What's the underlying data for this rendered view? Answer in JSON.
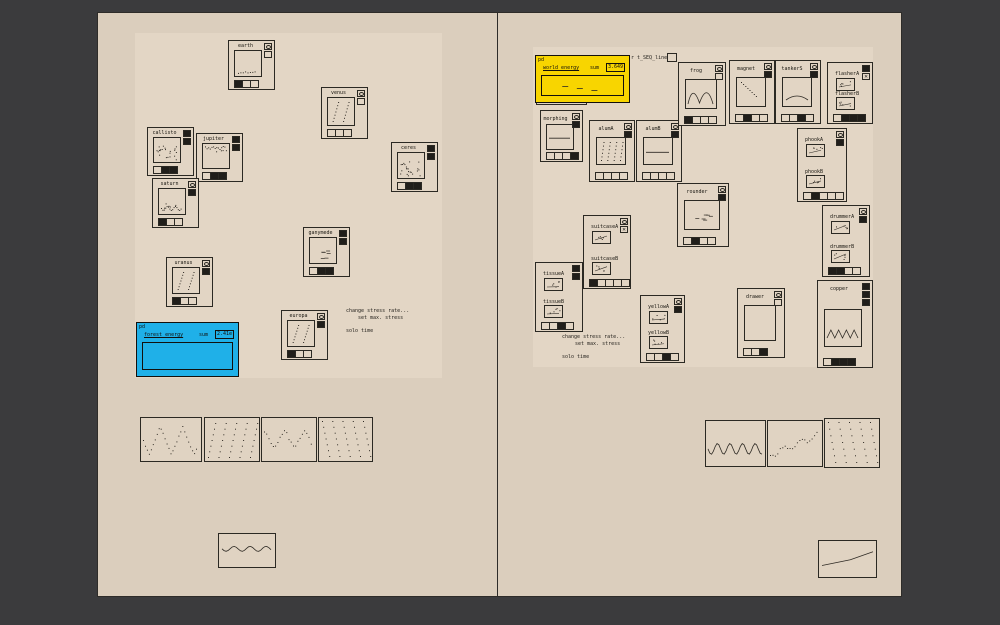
{
  "window": {
    "bg": "#3b3b3d",
    "page_bg": "#dbcebd",
    "panel_bg": "#e3d6c5",
    "accent_yellow": "#f8d500",
    "accent_blue": "#1fb0e8",
    "ink": "#2b2923"
  },
  "comments": {
    "left": {
      "line1": "change stress rate...",
      "line2": "set max. stress",
      "line3": "solo time"
    },
    "right": {
      "line1": "change stress rate...",
      "line2": "set max. stress",
      "line3": "solo time"
    }
  },
  "objects": {
    "saved_energy": {
      "label": "pd saved energy"
    },
    "receive_line": {
      "label": "r t_SEQ_line"
    }
  },
  "energy_boxes": [
    {
      "id": "forest",
      "pd_label": "pd",
      "name": "forest_energy",
      "sum_label": "sum",
      "value": "2.41e",
      "color": "#1fb0e8",
      "x": 136,
      "y": 322,
      "w": 103,
      "h": 55,
      "trace": "empty"
    },
    {
      "id": "world",
      "pd_label": "pd",
      "name": "world_energy",
      "sum_label": "sum",
      "value": "3.649",
      "color": "#f8d500",
      "x": 535,
      "y": 55,
      "w": 95,
      "h": 48,
      "trace": "edash"
    }
  ],
  "modules": [
    {
      "id": "earth",
      "label": "earth",
      "type": "planet",
      "x": 228,
      "y": 40,
      "w": 47,
      "h": 50,
      "trace": "dots-bottom",
      "top": [
        "bang",
        "toggle"
      ],
      "cells": [
        "d",
        "l",
        "l"
      ]
    },
    {
      "id": "venus",
      "label": "venus",
      "type": "planet",
      "x": 321,
      "y": 87,
      "w": 47,
      "h": 52,
      "trace": "diag2",
      "top": [
        "bang",
        "toggle"
      ],
      "cells": [
        "l",
        "l",
        "l"
      ]
    },
    {
      "id": "callisto",
      "label": "callisto",
      "type": "planet",
      "x": 147,
      "y": 127,
      "w": 47,
      "h": 49,
      "trace": "scatter",
      "top": [
        "dark",
        "dark"
      ],
      "cells": [
        "l",
        "d",
        "d"
      ]
    },
    {
      "id": "jupiter",
      "label": "jupiter",
      "type": "planet",
      "x": 196,
      "y": 133,
      "w": 47,
      "h": 49,
      "trace": "dots-top",
      "top": [
        "dark",
        "dark"
      ],
      "cells": [
        "l",
        "d",
        "d"
      ]
    },
    {
      "id": "saturn",
      "label": "saturn",
      "type": "planet",
      "x": 152,
      "y": 178,
      "w": 47,
      "h": 50,
      "trace": "wave-bottom",
      "top": [
        "bang",
        "dark"
      ],
      "cells": [
        "d",
        "l",
        "l"
      ]
    },
    {
      "id": "ceres",
      "label": "ceres",
      "type": "planet",
      "x": 391,
      "y": 142,
      "w": 47,
      "h": 50,
      "trace": "scatter",
      "top": [
        "dark",
        "dark"
      ],
      "cells": [
        "l",
        "d",
        "d"
      ]
    },
    {
      "id": "ganymede",
      "label": "ganymede",
      "type": "planet",
      "x": 303,
      "y": 227,
      "w": 47,
      "h": 50,
      "trace": "dashes",
      "top": [
        "dark",
        "dark"
      ],
      "cells": [
        "l",
        "d",
        "d"
      ]
    },
    {
      "id": "uranus",
      "label": "uranus",
      "type": "planet",
      "x": 166,
      "y": 257,
      "w": 47,
      "h": 50,
      "trace": "diag2",
      "top": [
        "bang",
        "dark"
      ],
      "cells": [
        "d",
        "l",
        "l"
      ]
    },
    {
      "id": "europa",
      "label": "europa",
      "type": "planet",
      "x": 281,
      "y": 310,
      "w": 47,
      "h": 50,
      "trace": "diag2",
      "top": [
        "bang",
        "dark"
      ],
      "cells": [
        "d",
        "l",
        "l"
      ]
    },
    {
      "id": "morphing",
      "label": "morphing",
      "type": "tall",
      "x": 540,
      "y": 110,
      "w": 43,
      "h": 52,
      "trace": "flat",
      "top": [
        "bang",
        "dark"
      ],
      "cells": [
        "l",
        "l",
        "l",
        "d"
      ],
      "g": [
        5,
        13,
        28,
        26
      ]
    },
    {
      "id": "alumA",
      "label": "alumA",
      "type": "tall",
      "x": 589,
      "y": 120,
      "w": 46,
      "h": 62,
      "trace": "vstripes",
      "top": [
        "bang",
        "dark"
      ],
      "cells": [
        "l",
        "l",
        "l",
        "l"
      ]
    },
    {
      "id": "alumB",
      "label": "alumB",
      "type": "tall",
      "x": 636,
      "y": 120,
      "w": 46,
      "h": 62,
      "trace": "flat",
      "top": [
        "bang",
        "dark"
      ],
      "cells": [
        "l",
        "l",
        "l",
        "l"
      ]
    },
    {
      "id": "frog",
      "label": "frog",
      "type": "tall",
      "x": 678,
      "y": 62,
      "w": 48,
      "h": 64,
      "trace": "bumps",
      "top": [
        "bang",
        "toggle"
      ],
      "cells": [
        "d",
        "l",
        "l",
        "l"
      ]
    },
    {
      "id": "magnet",
      "label": "magnet",
      "type": "tall",
      "x": 729,
      "y": 60,
      "w": 46,
      "h": 64,
      "trace": "falldots",
      "top": [
        "bang",
        "dark"
      ],
      "cells": [
        "l",
        "d",
        "l",
        "l"
      ]
    },
    {
      "id": "tankerS",
      "label": "tankerS",
      "type": "tall",
      "x": 775,
      "y": 60,
      "w": 46,
      "h": 64,
      "trace": "arc",
      "top": [
        "bang",
        "dark"
      ],
      "cells": [
        "l",
        "l",
        "d",
        "l"
      ]
    },
    {
      "id": "flasher",
      "sub_a": "flasherA",
      "sub_b": "flasherB",
      "type": "dual",
      "x": 827,
      "y": 62,
      "w": 46,
      "h": 62,
      "top": [
        "dark",
        "xtog"
      ],
      "cells": [
        "l",
        "d",
        "d",
        "d"
      ]
    },
    {
      "id": "phook",
      "sub_a": "phookA",
      "sub_b": "phookB",
      "type": "dual",
      "x": 797,
      "y": 128,
      "w": 50,
      "h": 74,
      "top": [
        "bang",
        "dark"
      ],
      "cells": [
        "l",
        "d",
        "l",
        "l",
        "l"
      ]
    },
    {
      "id": "rounder",
      "label": "rounder",
      "type": "tall",
      "x": 677,
      "y": 183,
      "w": 52,
      "h": 64,
      "trace": "dashes",
      "top": [
        "bang",
        "dark"
      ],
      "cells": [
        "l",
        "d",
        "l",
        "l"
      ]
    },
    {
      "id": "suitcase",
      "sub_a": "suitcaseA",
      "sub_b": "suitcaseB",
      "type": "dual",
      "x": 583,
      "y": 215,
      "w": 48,
      "h": 74,
      "top": [
        "bang",
        "xtog"
      ],
      "cells": [
        "d",
        "l",
        "l",
        "l",
        "l"
      ]
    },
    {
      "id": "drummer",
      "sub_a": "drummerA",
      "sub_b": "drummerB",
      "type": "dual",
      "x": 822,
      "y": 205,
      "w": 48,
      "h": 72,
      "top": [
        "bang",
        "dark"
      ],
      "cells": [
        "d",
        "d",
        "l",
        "l"
      ]
    },
    {
      "id": "tissue",
      "sub_a": "tissueA",
      "sub_b": "tissueB",
      "type": "dual",
      "x": 535,
      "y": 262,
      "w": 48,
      "h": 70,
      "top": [
        "dark",
        "dark"
      ],
      "cells": [
        "l",
        "l",
        "d",
        "l"
      ]
    },
    {
      "id": "yellow",
      "sub_a": "yellowA",
      "sub_b": "yellowB",
      "type": "dual",
      "x": 640,
      "y": 295,
      "w": 45,
      "h": 68,
      "top": [
        "bang",
        "dark"
      ],
      "cells": [
        "l",
        "l",
        "d",
        "l"
      ]
    },
    {
      "id": "drawer",
      "label": "drawer",
      "type": "tall",
      "x": 737,
      "y": 288,
      "w": 48,
      "h": 70,
      "trace": "empty",
      "top": [
        "bang",
        "toggle"
      ],
      "cells": [
        "l",
        "l",
        "d"
      ]
    },
    {
      "id": "copper",
      "label": "copper",
      "type": "tall",
      "x": 817,
      "y": 280,
      "w": 56,
      "h": 88,
      "trace": "zigzag",
      "top": [
        "dark",
        "dark",
        "dark"
      ],
      "cells": [
        "l",
        "d",
        "d",
        "d"
      ],
      "g": [
        6,
        28,
        38,
        38
      ]
    }
  ],
  "arrays": [
    {
      "id": "arr-l1",
      "x": 140,
      "y": 417,
      "w": 62,
      "h": 45,
      "trace": "zigzagdots"
    },
    {
      "id": "arr-l2",
      "x": 204,
      "y": 417,
      "w": 56,
      "h": 45,
      "trace": "stripes-up"
    },
    {
      "id": "arr-l3",
      "x": 261,
      "y": 417,
      "w": 56,
      "h": 45,
      "trace": "wavescatter"
    },
    {
      "id": "arr-l4",
      "x": 318,
      "y": 417,
      "w": 55,
      "h": 45,
      "trace": "stripes-down"
    },
    {
      "id": "arr-l5",
      "x": 218,
      "y": 533,
      "w": 58,
      "h": 35,
      "trace": "wavyline"
    },
    {
      "id": "arr-r1",
      "x": 705,
      "y": 420,
      "w": 61,
      "h": 47,
      "trace": "sine"
    },
    {
      "id": "arr-r2",
      "x": 767,
      "y": 420,
      "w": 56,
      "h": 47,
      "trace": "risedots"
    },
    {
      "id": "arr-r3",
      "x": 824,
      "y": 418,
      "w": 56,
      "h": 50,
      "trace": "stripes-down"
    },
    {
      "id": "arr-r4",
      "x": 818,
      "y": 540,
      "w": 59,
      "h": 38,
      "trace": "riseline"
    }
  ]
}
